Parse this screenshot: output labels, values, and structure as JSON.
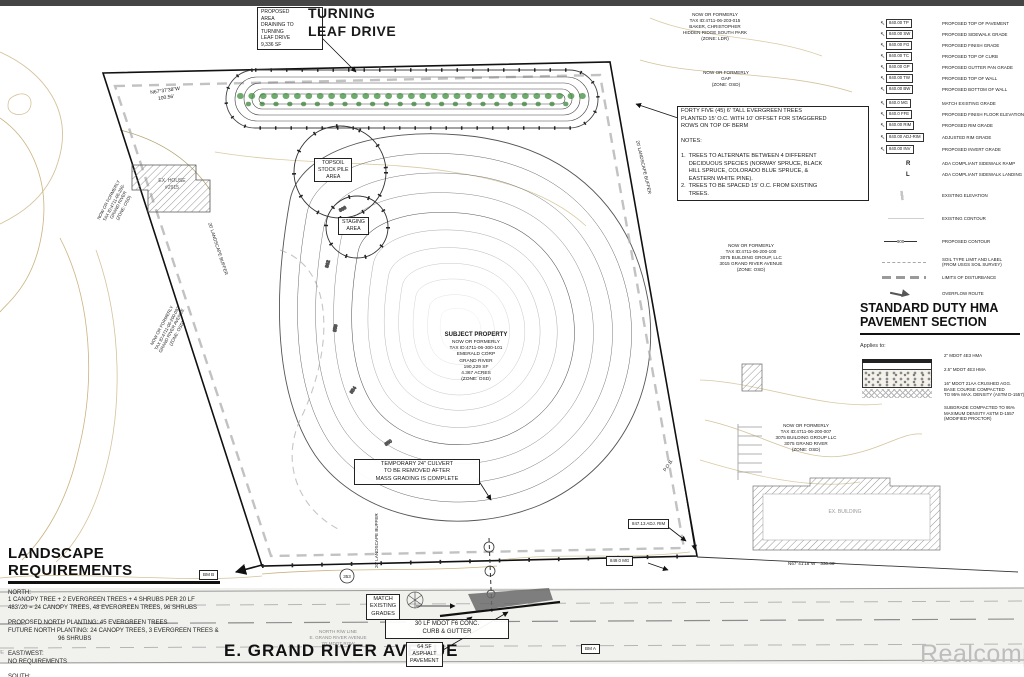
{
  "watermark": "Realcomp",
  "plan": {
    "drain_box": "PROPOSED\nAREA\nDRAINING TO\nTURNING\nLEAF DRIVE\n9,336 SF",
    "turning_leaf": "TURNING\nLEAF DRIVE",
    "nf_baker": "NOW OR FORMERLY\nTAX ID:4711-06-203-015\nBAKER, CHRISTOPHER\nHIDDEN RIDGE SOUTH PARK\n(ZONE: LDR)",
    "nf_gap": "NOW OR FORMERLY\nGAP\n(ZONE: OSD)",
    "tree_note": "FORTY FIVE (45) 6' TALL EVERGREEN TREES\nPLANTED 15' O.C. WITH 10' OFFSET FOR STAGGERED\nROWS ON TOP OF BERM\n\nNOTES:\n\n1.  TREES TO ALTERNATE BETWEEN 4 DIFFERENT\n     DECIDUOUS SPECIES (NORWAY SPRUCE, BLACK\n     HILL SPRUCE, COLORADO BLUE SPRUCE, &\n     EASTERN WHITE PINE).\n2.  TREES TO BE SPACED 15' O.C. FROM EXISTING\n     TREES.",
    "bearing_nw": "N67°37'38\"W\n100.56'",
    "ex_house": "EX. HOUSE\n#2915",
    "nf_left_upper": "NOW OR FORMERLY\nTAX ID:4711-06-200-\nGRAND RIVER\n(ZONE: OSD)",
    "nf_left_lower": "NOW OR FORMERLY\nTAX ID:4711-06-200-092\nGRAND RIVER AVENUE\n(ZONE: OSD)",
    "buffer_label": "20' LANDSCAPE BUFFER",
    "topsoil": "TOPSOIL\nSTOCK PILE\nAREA",
    "staging": "STAGING\nAREA",
    "nf_3015": "NOW OR FORMERLY\nTAX ID:4711-06-200-100\n3075 BUILDING GROUP, LLC\n3015 GRAND RIVER AVENUE\n(ZONE: OSD)",
    "subject_title": "SUBJECT PROPERTY",
    "subject_body": "NOW OR FORMERLY\nTAX ID:4711-06-300-101\nEMERALD CORP\nGRAND RIVER\n190,229 SF\n4.367 ACRES\n(ZONE: OSD)",
    "nf_3075": "NOW OR FORMERLY\nTAX ID:4711-06-200-007\n3075 BUILDING GROUP LLC\n3075 GRAND RIVER\n(ZONE: OSD)",
    "culvert_box": "TEMPORARY 24\" CULVERT\nTO BE REMOVED AFTER\nMASS GRADING IS COMPLETE",
    "adj_rim": "847.13 ADJ. RIM",
    "mg_849": "849.0 MG",
    "pob": "P.O.B.",
    "bearing_se": "N67°41'18\"W    330.00'",
    "ex_building": "EX. BUILDING",
    "bm_a": "BM A",
    "bm_b": "BM B",
    "match_grades": "MATCH\nEXISTING\nGRADES",
    "curb_box": "30 LF MDOT F6 CONC.\nCURB & GUTTER",
    "asphalt_box": "64 SF\nASPHALT\nPAVEMENT",
    "rw_note": "NORTH R/W LINE\nE. GRAND RIVER AVENUE\n70' MDOT ROW",
    "grand_river_label": "E. GRAND RIVER AVENUE",
    "struct_circle": "353",
    "contour_labels": [
      "866",
      "862",
      "858",
      "854",
      "850",
      "848"
    ]
  },
  "legend": {
    "items": [
      {
        "label": "840.00 TP",
        "desc": "PROPOSED TOP OF PAVEMENT"
      },
      {
        "label": "840.00 SW",
        "desc": "PROPOSED SIDEWALK GRADE"
      },
      {
        "label": "840.00 FG",
        "desc": "PROPOSED FINISH GRADE"
      },
      {
        "label": "840.00 TC",
        "desc": "PROPOSED TOP OF CURB"
      },
      {
        "label": "840.00 GP",
        "desc": "PROPOSED GUTTER PAN GRADE"
      },
      {
        "label": "840.00 TW",
        "desc": "PROPOSED TOP OF WALL"
      },
      {
        "label": "840.00 BW",
        "desc": "PROPOSED BOTTOM OF WALL"
      },
      {
        "label": "840.0 MG",
        "desc": "MATCH EXISTING GRADE"
      },
      {
        "label": "840.0 FFE",
        "desc": "PROPOSED FINISH FLOOR ELEVATION"
      },
      {
        "label": "840.00 RIM",
        "desc": "PROPOSED RIM GRADE"
      },
      {
        "label": "840.00 ADJ-RIM",
        "desc": "ADJUSTED RIM GRADE"
      },
      {
        "label": "840.00 INV",
        "desc": "PROPOSED INVERT GRADE"
      },
      {
        "label": "R",
        "desc": "ADA COMPLIANT SIDEWALK RAMP"
      },
      {
        "label": "L",
        "desc": "ADA COMPLIANT SIDEWALK LANDING"
      },
      {
        "label": "",
        "desc": "EXISTING ELEVATION"
      },
      {
        "label": "",
        "desc": "EXISTING CONTOUR"
      },
      {
        "label": "900",
        "desc": "PROPOSED CONTOUR"
      },
      {
        "label": "",
        "desc": "SOIL TYPE LIMIT AND LABEL\n(FROM USGS SOIL SURVEY)"
      },
      {
        "label": "",
        "desc": "LIMITS OF DISTURBANCE"
      },
      {
        "label": "",
        "desc": "OVERFLOW ROUTE"
      }
    ]
  },
  "pavement": {
    "title": "STANDARD DUTY HMA\nPAVEMENT SECTION",
    "applies_to": "Applies to:",
    "callouts": [
      "2\" MDOT 4E3 HMA",
      "2.5\" MDOT 4E3 HMA",
      "16\" MDOT 21AA CRUSHED AGG.\nBASE COURSE COMPACTED\nTO 95% MAX. DENSITY (ASTM D-1557)",
      "SUBGRADE COMPACTED TO 95%\nMAXIMUM DENSITY ASTM D-1557\n(MODIFIED PROCTOR)"
    ]
  },
  "landscape": {
    "title": "LANDSCAPE REQUIREMENTS",
    "body": "NORTH:\n1 CANOPY TREE + 2 EVERGREEN TREES + 4 SHRUBS PER 20 LF\n483'/20 = 24 CANOPY TREES, 48 EVERGREEN TREES, 96 SHRUBS\n\nPROPOSED NORTH PLANTING: 45 EVERGREEN TREES\nFUTURE NORTH PLANTING: 24 CANOPY TREES, 3 EVERGREEN TREES &\n                              96 SHRUBS\n\nEAST/WEST:\nNO REQUIREMENTS\n\nSOUTH:\n1 CANOPY TREE PER 40 LF\n398'/40 = 10 CANOPY TREES"
  }
}
